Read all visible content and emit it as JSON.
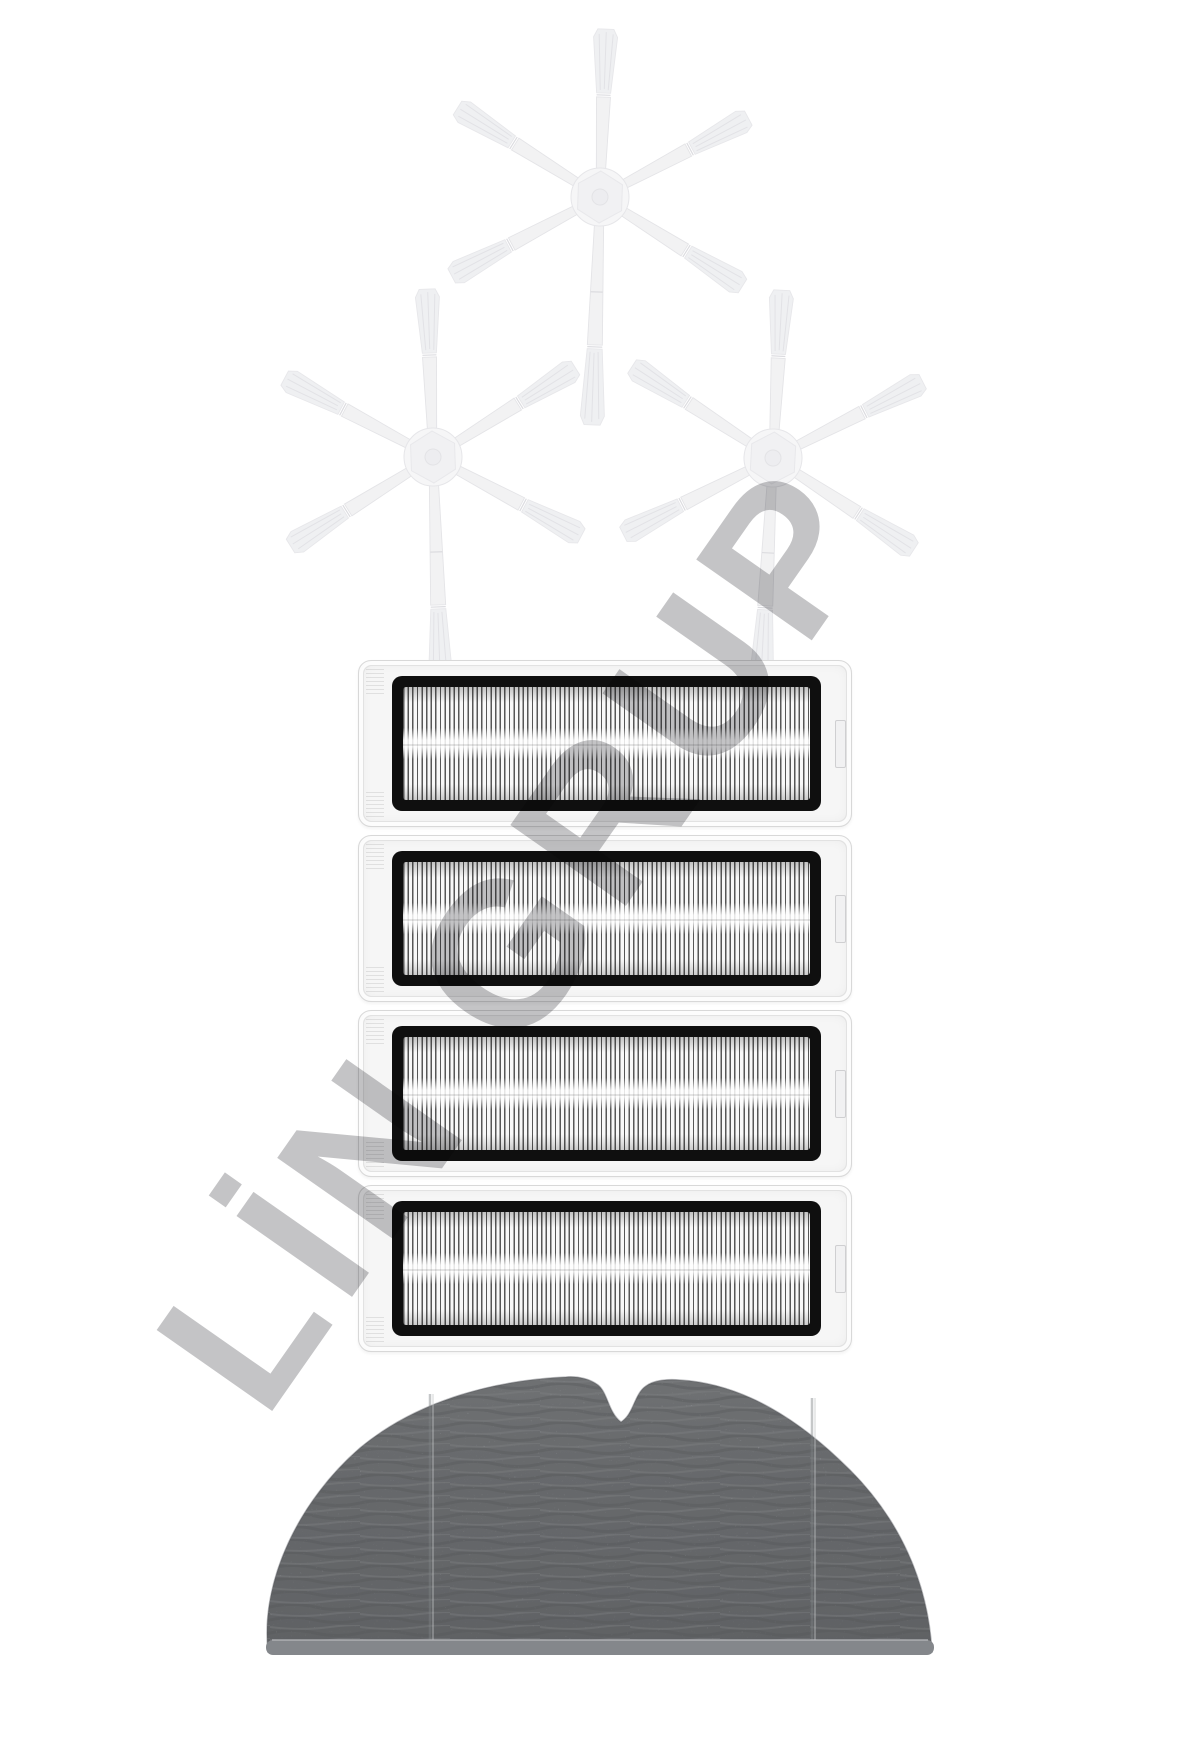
{
  "watermark": {
    "text": "LİN GRUP",
    "color": "#bfbfc1",
    "rotation_deg": -55
  },
  "products": {
    "side_brushes": {
      "name": "six-arm side brush",
      "count": 3
    },
    "hepa_filters": {
      "name": "HEPA filter",
      "count": 4
    },
    "mop_pads": {
      "name": "mop pad",
      "count": 1
    }
  },
  "colors": {
    "background": "#ffffff",
    "brush-fill": "#f2f2f3",
    "brush-edge": "#e4e4e7",
    "brush-hub": "#f6f6f7",
    "filter-outer": "#f6f6f6",
    "filter-outer-edge": "#d8d8d8",
    "filter-frame": "#0f0f0f",
    "pleat-dark": "#565656",
    "pleat-light": "#f8f8f8",
    "mop-base": "#9b9ea2",
    "mop-dark": "#85888c",
    "mop-light": "#b0b3b6",
    "watermark": "#bfbfc1"
  }
}
